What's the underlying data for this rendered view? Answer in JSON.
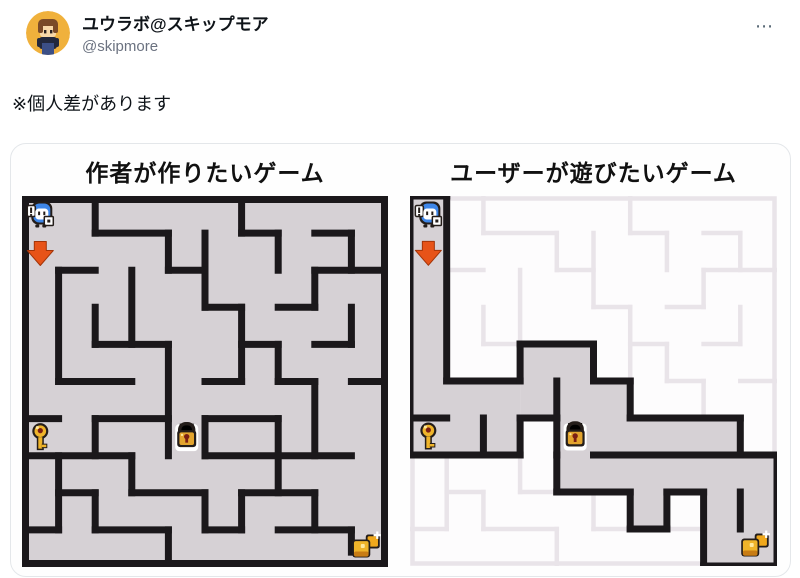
{
  "header": {
    "display_name": "ユウラボ@スキップモア",
    "handle": "@skipmore",
    "more_label": "⋯"
  },
  "tweet": {
    "text": "※個人差があります"
  },
  "figure": {
    "left_title": "作者が作りたいゲーム",
    "right_title": "ユーザーが遊びたいゲーム",
    "grid": 10,
    "colors": {
      "wall": "#1b181b",
      "floor": "#d6d1d5",
      "unexplored": "#fdfcfd",
      "ghost": "#e9e4e9",
      "outline_dark": "#241d1a",
      "arrow": "#e75318",
      "arrow_edge": "#a33408",
      "gold": "#efb42a",
      "gold_light": "#ffe9a0",
      "gold_shadow": "#c87c14",
      "lock_body": "#e3a42e",
      "keyhole": "#7c1f14",
      "blue": "#3e86e8",
      "white": "#ffffff"
    },
    "left_maze": {
      "walls": [
        [
          2,
          0,
          2,
          1
        ],
        [
          6,
          0,
          6,
          1
        ],
        [
          4,
          1,
          4,
          2
        ],
        [
          7,
          1,
          7,
          2
        ],
        [
          9,
          1,
          9,
          2
        ],
        [
          5,
          1,
          5,
          3
        ],
        [
          1,
          2,
          1,
          5
        ],
        [
          3,
          2,
          3,
          4
        ],
        [
          8,
          2,
          8,
          3
        ],
        [
          2,
          3,
          2,
          4
        ],
        [
          6,
          3,
          6,
          5
        ],
        [
          9,
          3,
          9,
          4
        ],
        [
          4,
          4,
          4,
          7
        ],
        [
          7,
          4,
          7,
          5
        ],
        [
          8,
          5,
          8,
          7
        ],
        [
          2,
          6,
          2,
          7
        ],
        [
          5,
          6,
          5,
          7
        ],
        [
          7,
          6,
          7,
          8
        ],
        [
          1,
          7,
          1,
          9
        ],
        [
          3,
          7,
          3,
          8
        ],
        [
          2,
          8,
          2,
          9
        ],
        [
          5,
          8,
          5,
          9
        ],
        [
          6,
          8,
          6,
          9
        ],
        [
          8,
          8,
          8,
          9
        ],
        [
          4,
          9,
          4,
          10
        ],
        [
          9,
          9,
          9,
          9.6
        ],
        [
          2,
          1,
          4,
          1
        ],
        [
          6,
          1,
          7,
          1
        ],
        [
          8,
          1,
          9,
          1
        ],
        [
          1,
          2,
          2,
          2
        ],
        [
          4,
          2,
          5,
          2
        ],
        [
          8,
          2,
          10,
          2
        ],
        [
          5,
          3,
          6,
          3
        ],
        [
          7,
          3,
          8,
          3
        ],
        [
          2,
          4,
          4,
          4
        ],
        [
          6,
          4,
          7,
          4
        ],
        [
          8,
          4,
          9,
          4
        ],
        [
          1,
          5,
          3,
          5
        ],
        [
          5,
          5,
          6,
          5
        ],
        [
          7,
          5,
          8,
          5
        ],
        [
          9,
          5,
          10,
          5
        ],
        [
          0,
          6,
          1,
          6
        ],
        [
          2,
          6,
          4,
          6
        ],
        [
          5,
          6,
          7,
          6
        ],
        [
          0,
          7,
          3,
          7
        ],
        [
          5,
          7,
          9,
          7
        ],
        [
          1,
          8,
          2,
          8
        ],
        [
          3,
          8,
          5,
          8
        ],
        [
          6,
          8,
          8,
          8
        ],
        [
          0,
          9,
          1,
          9
        ],
        [
          2,
          9,
          4,
          9
        ],
        [
          5,
          9,
          6,
          9
        ],
        [
          7,
          9,
          9,
          9
        ]
      ],
      "sprites": [
        {
          "icon": "player-sprite",
          "cell": [
            0.5,
            0.5
          ]
        },
        {
          "icon": "down-arrow-icon",
          "cell": [
            0.5,
            1.55
          ]
        },
        {
          "icon": "key-icon",
          "cell": [
            0.5,
            6.5
          ]
        },
        {
          "icon": "lock-icon",
          "cell": [
            4.5,
            6.5
          ]
        },
        {
          "icon": "treasure-icon",
          "cell": [
            9.42,
            9.42
          ]
        }
      ]
    },
    "right_maze": {
      "revealed_rects": [
        [
          0,
          0,
          1,
          5
        ],
        [
          0,
          5,
          3,
          2
        ],
        [
          3,
          4,
          2,
          2
        ],
        [
          5,
          5,
          1,
          1
        ],
        [
          4,
          6,
          5,
          1
        ],
        [
          4,
          7,
          6,
          1
        ],
        [
          6,
          8,
          1,
          1
        ],
        [
          8,
          8,
          2,
          2
        ]
      ],
      "walls": [
        [
          0,
          0,
          1,
          0
        ],
        [
          0,
          0,
          0,
          7
        ],
        [
          10,
          7,
          10,
          10
        ],
        [
          8,
          10,
          10,
          10
        ],
        [
          1,
          0,
          1,
          5
        ],
        [
          1,
          5,
          3,
          5
        ],
        [
          3,
          4,
          3,
          5
        ],
        [
          3,
          4,
          5,
          4
        ],
        [
          5,
          4,
          5,
          5
        ],
        [
          5,
          5,
          6,
          5
        ],
        [
          6,
          5,
          6,
          6
        ],
        [
          6,
          6,
          9,
          6
        ],
        [
          9,
          6,
          9,
          7
        ],
        [
          9,
          7,
          10,
          7
        ],
        [
          5,
          7,
          9,
          7
        ],
        [
          4,
          8,
          6,
          8
        ],
        [
          6,
          8,
          6,
          9
        ],
        [
          6,
          9,
          7,
          9
        ],
        [
          7,
          8,
          7,
          9
        ],
        [
          7,
          8,
          8,
          8
        ],
        [
          8,
          8,
          8,
          10
        ],
        [
          9,
          8,
          9,
          9
        ],
        [
          0,
          6,
          1,
          6
        ],
        [
          2,
          6,
          2,
          7
        ],
        [
          4,
          5,
          4,
          6
        ],
        [
          0,
          7,
          3,
          7
        ],
        [
          3,
          6,
          3,
          7
        ],
        [
          3,
          6,
          4,
          6
        ],
        [
          4,
          6,
          4,
          7
        ],
        [
          4,
          7,
          4,
          8
        ]
      ],
      "sprites": [
        {
          "icon": "player-sprite",
          "cell": [
            0.5,
            0.5
          ]
        },
        {
          "icon": "down-arrow-icon",
          "cell": [
            0.5,
            1.55
          ]
        },
        {
          "icon": "key-icon",
          "cell": [
            0.5,
            6.5
          ]
        },
        {
          "icon": "lock-icon",
          "cell": [
            4.5,
            6.5
          ]
        },
        {
          "icon": "treasure-icon",
          "cell": [
            9.42,
            9.42
          ]
        }
      ]
    }
  }
}
